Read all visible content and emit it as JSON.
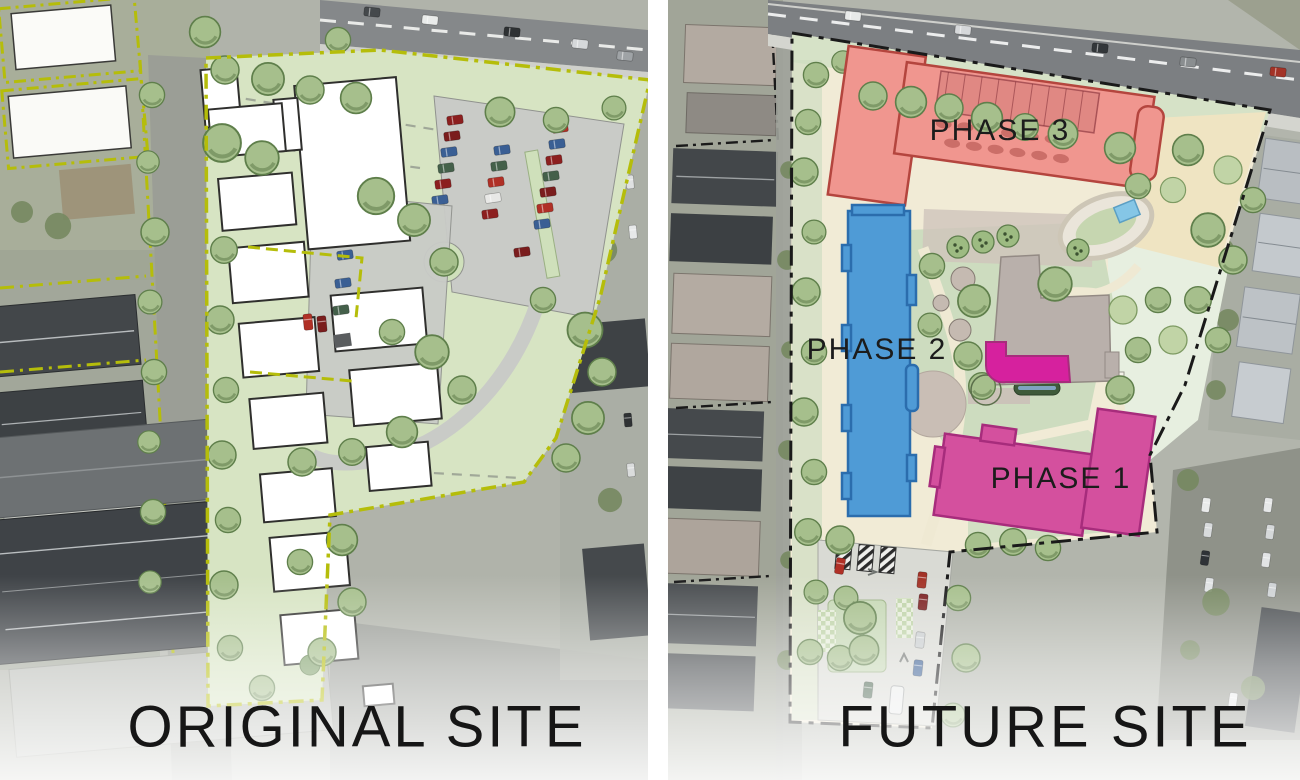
{
  "page": {
    "width": 1300,
    "height": 780,
    "kind": "site plan comparison rendering over aerial photo"
  },
  "panels": {
    "original": {
      "title": "ORIGINAL SITE"
    },
    "future": {
      "title": "FUTURE SITE",
      "phases": [
        {
          "id": 1,
          "label": "PHASE 1",
          "fill": "#d4509e",
          "outline": "#a72c7c"
        },
        {
          "id": 2,
          "label": "PHASE 2",
          "fill": "#4f9bd6",
          "outline": "#2b6dad"
        },
        {
          "id": 3,
          "label": "PHASE 3",
          "fill": "#f0968f",
          "outline": "#b4453e"
        }
      ],
      "amenity_fill": "#d6219e"
    }
  },
  "colors": {
    "original_boundary": "#b5bd0a",
    "future_boundary": "#1a1a1a",
    "label_text": "#1c1c1c",
    "lawn_green": "#d7e4c3",
    "plan_cream": "#f1ebd6",
    "pool_blue": "#85c6e6"
  }
}
